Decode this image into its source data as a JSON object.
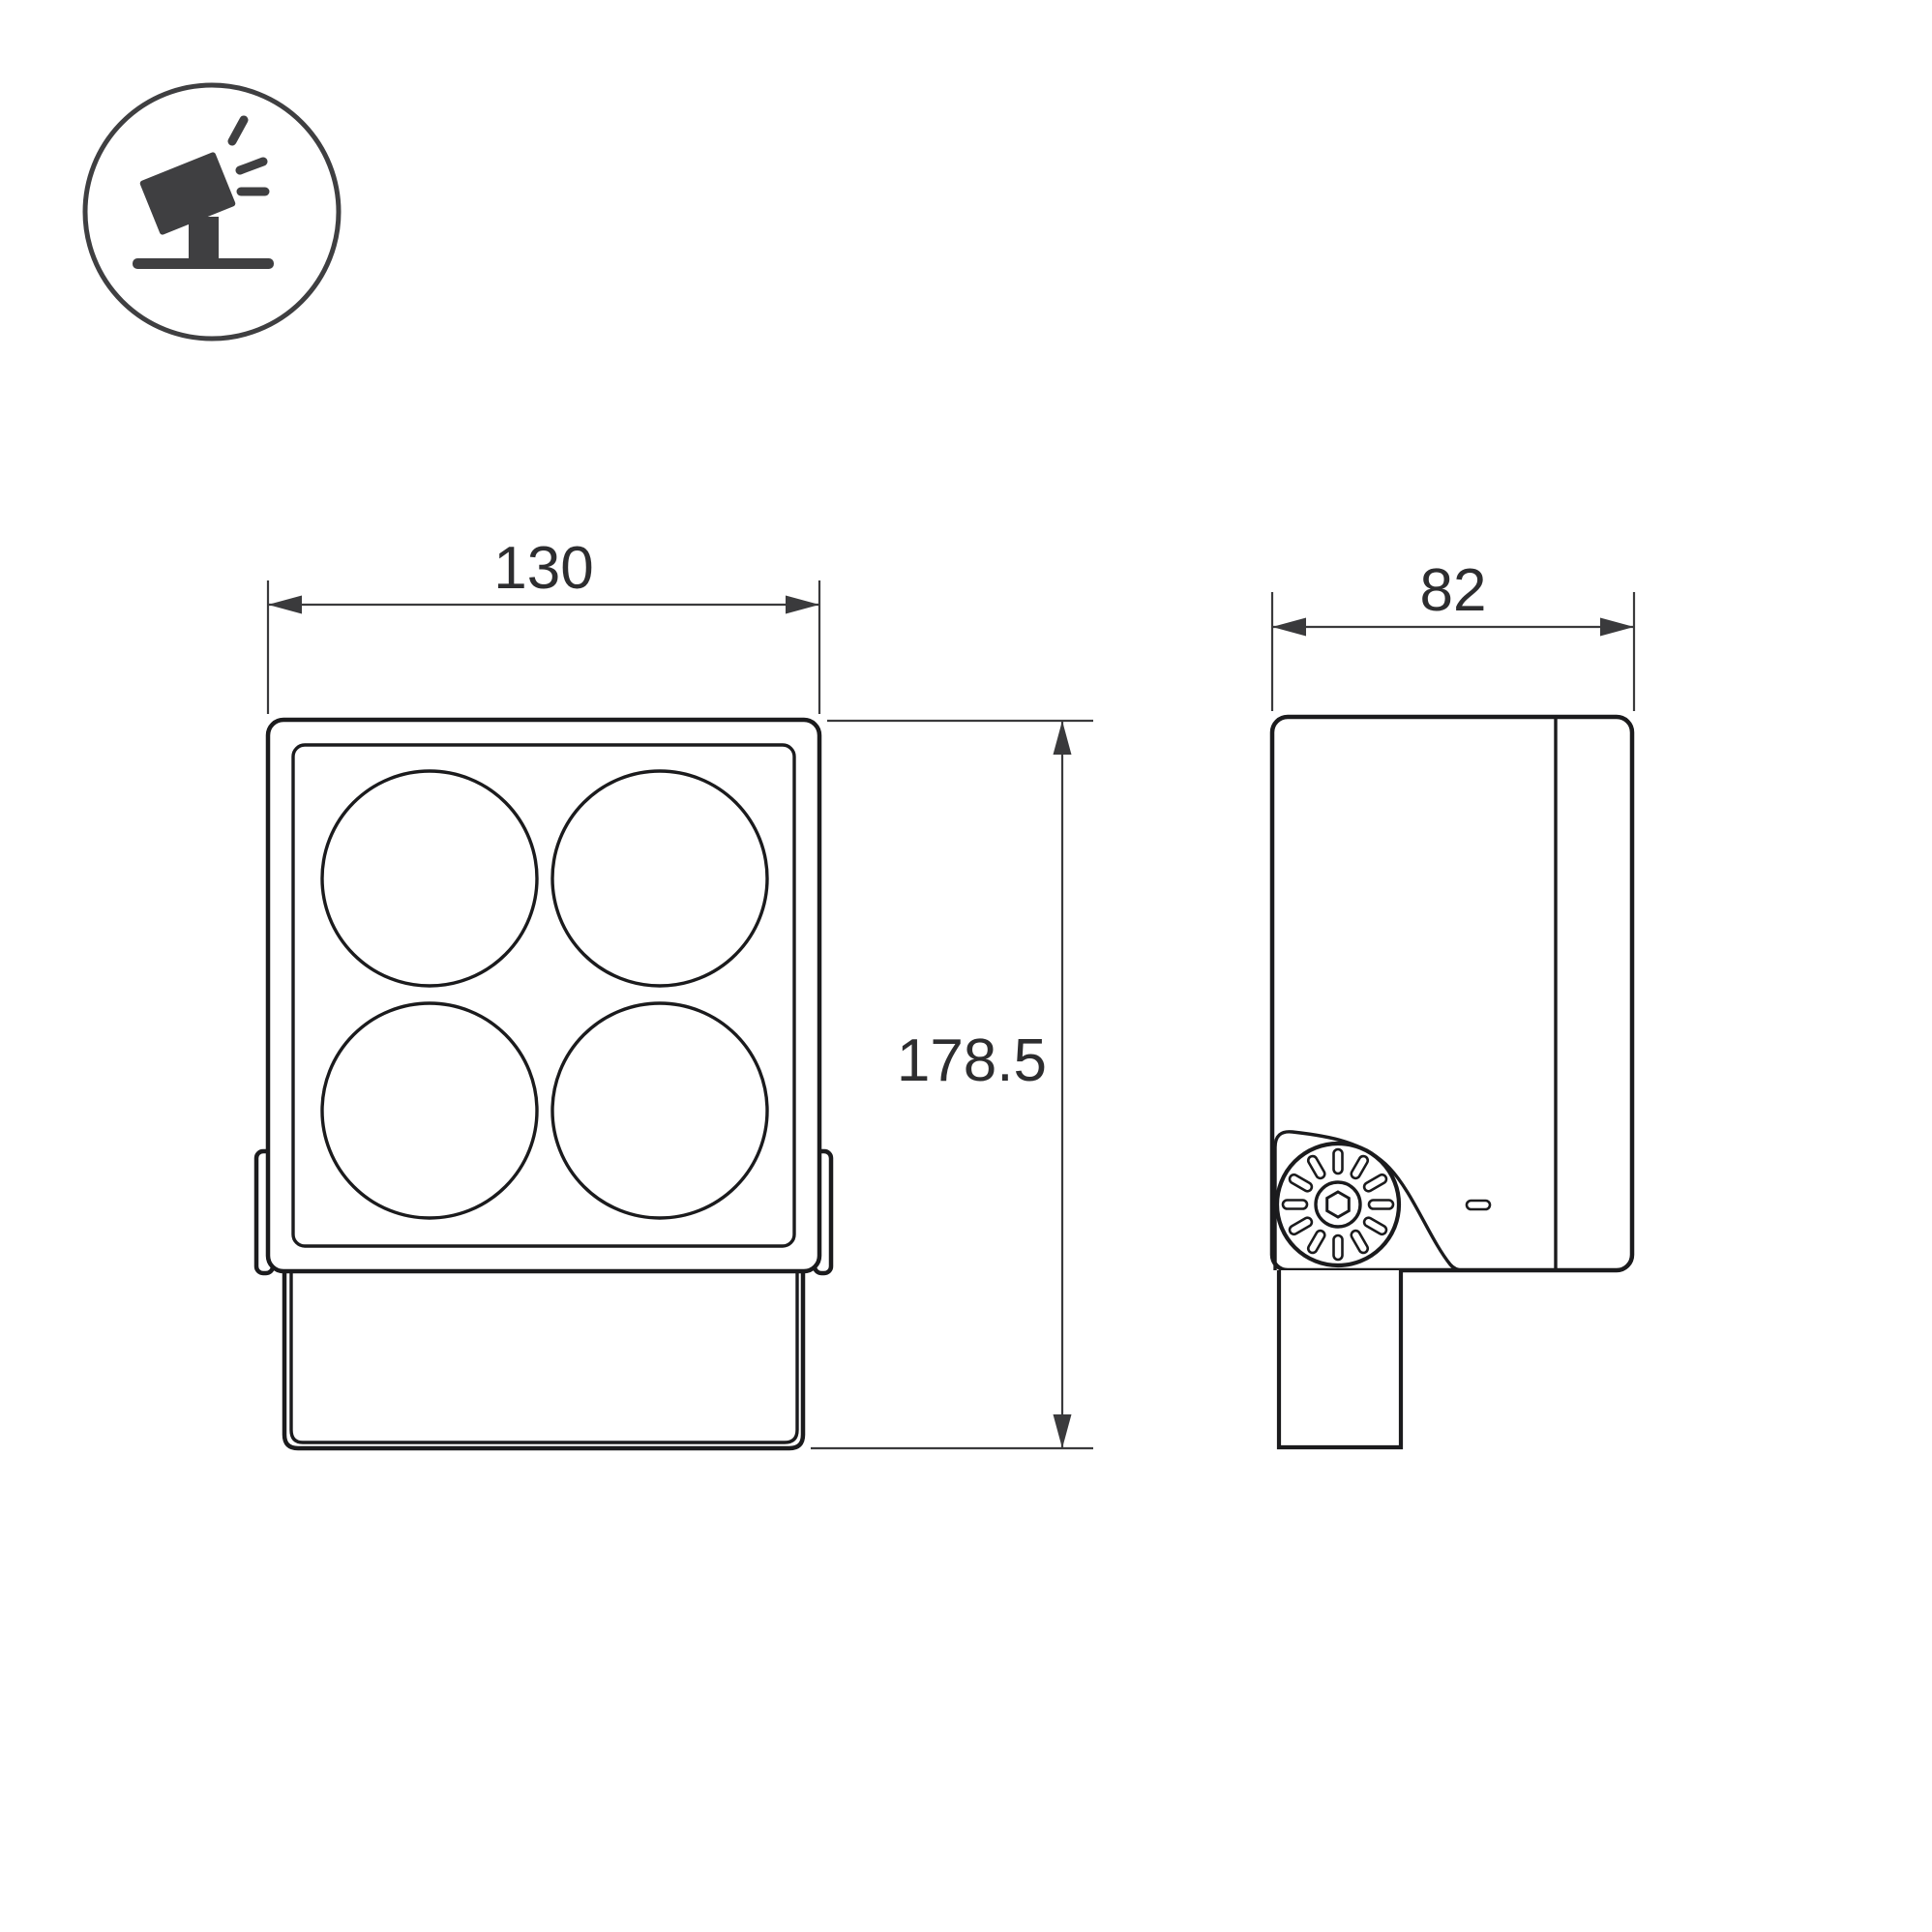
{
  "drawing": {
    "type": "technical-dimension-drawing",
    "subject": "LED floodlight / spotlight fixture — front view and side view",
    "views": {
      "front": "square head with 4 round lenses and lower driver box",
      "side": "housing with hinged mounting bracket, knurled adjustment knob and stem"
    },
    "dimensions": {
      "front_width": "130",
      "side_depth": "82",
      "overall_height": "178.5"
    },
    "icon": {
      "name": "floodlight-icon",
      "description": "tilted floodlight on ground stand emitting rays, inside circle badge"
    },
    "colors": {
      "background": "#ffffff",
      "part_line": "#1b1b1d",
      "dimension_line": "#3a3a3c",
      "text": "#2d2d2f"
    }
  }
}
